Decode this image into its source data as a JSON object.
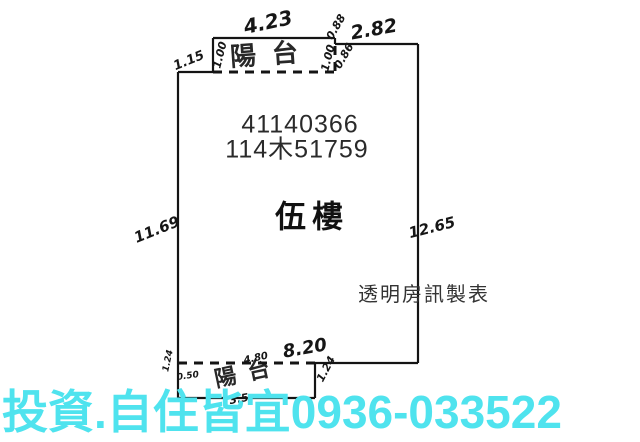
{
  "colors": {
    "watermark": "#4fe3ee",
    "line": "#141414"
  },
  "plan": {
    "registration_line1": "41140366",
    "registration_line2": "114木51759",
    "floor_label": "伍樓",
    "maker_label": "透明房訊製表",
    "top_balcony": {
      "label": "陽台",
      "width": "4.23",
      "left_depth": "1.00",
      "right_depth": "1.00"
    },
    "dimensions": {
      "top_left_jog": "1.15",
      "top_right_width": "2.82",
      "right_jog_upper": "0.88",
      "right_jog_lower": "0.86",
      "left_height": "11.69",
      "right_height": "12.65",
      "bottom_width": "8.20"
    },
    "bottom_balcony": {
      "label": "陽台",
      "width": "4.80",
      "right_depth": "1.24",
      "left_outer_dim": "1.24",
      "left_inner_dim": "0.50",
      "bottom_partial_dim": "3.5"
    }
  },
  "watermark": {
    "text": "投資.自住皆宜0936-033522"
  }
}
